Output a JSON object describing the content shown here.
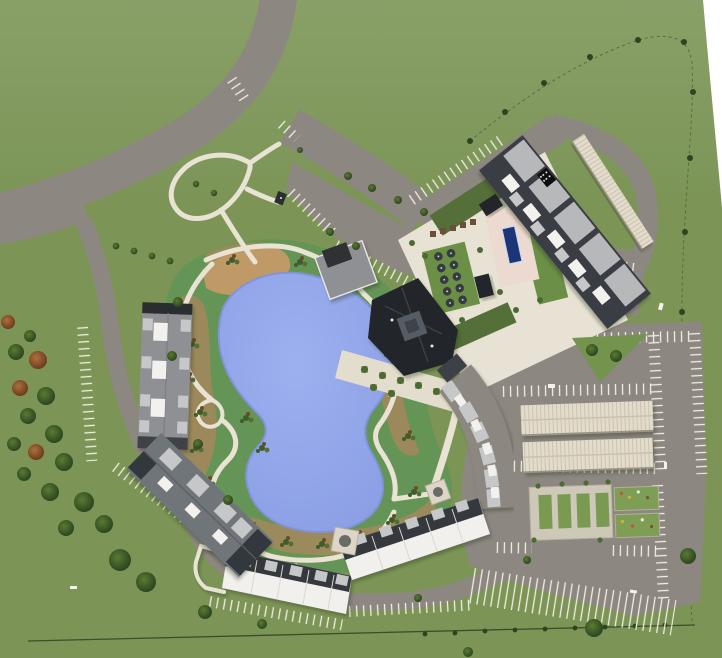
{
  "scene": {
    "aria_label": "Aerial site plan rendering of a lakeside residential community with clubhouse, pool courtyard, apartment buildings, walking trails, parking lots, carports and garden area",
    "view": "top-down aerial rendering",
    "visible_text": "none"
  },
  "palette": {
    "grass": "#7c9557",
    "road": "#8d8782",
    "path": "#e9e3d4",
    "stripe": "#f1eee2",
    "lake": "#93a6e9",
    "lake_edge": "#8193dc",
    "turf": "#649556",
    "mulch": "#a5885c",
    "beach": "#bf9a67",
    "roof_dark": "#3a3e44",
    "roof_black": "#23262c",
    "roof_gray": "#8f9094",
    "roof_panel": "#b7b8b9",
    "roof_white": "#f2f1ee",
    "carport": "#e3dccc",
    "carport_rib": "#cbc3ae",
    "pool": "#1c3577",
    "deck": "#ecd9cf",
    "court_green": "#6c8f48",
    "hedge": "#556f38",
    "umbrella": "#363b42",
    "tree_rust": "#9a5b31",
    "boundary": "#3c4d2a",
    "white": "#ffffff"
  },
  "features": {
    "pond": {
      "label": "Pond"
    },
    "beach": {
      "label": "Beach cove"
    },
    "trails": {
      "label": "Walking trail loop"
    },
    "clubhouse": {
      "label": "Clubhouse with tower"
    },
    "pool": {
      "label": "Lap pool"
    },
    "umbrella_lawn": {
      "label": "Umbrella lounge lawn",
      "umbrella_count": 10
    },
    "courtyard": {
      "label": "Amenity courtyard"
    },
    "building_ne": {
      "label": "Northeast apartment building"
    },
    "building_center": {
      "label": "Central apartment chain"
    },
    "townhomes": {
      "label": "White-roof townhome chain",
      "segments": 2
    },
    "building_w1": {
      "label": "West apartment building"
    },
    "building_w2": {
      "label": "Southwest apartment building"
    },
    "carports": {
      "label": "Covered carports",
      "count_main_lot": 2,
      "count_northeast": 1
    },
    "garden": {
      "label": "Garden and dog-run pad",
      "plot_count": 4
    },
    "parking": {
      "label": "Surface parking lots"
    },
    "loop_road": {
      "label": "Curved entry road"
    },
    "boundary": {
      "label": "Property line with street trees"
    }
  }
}
